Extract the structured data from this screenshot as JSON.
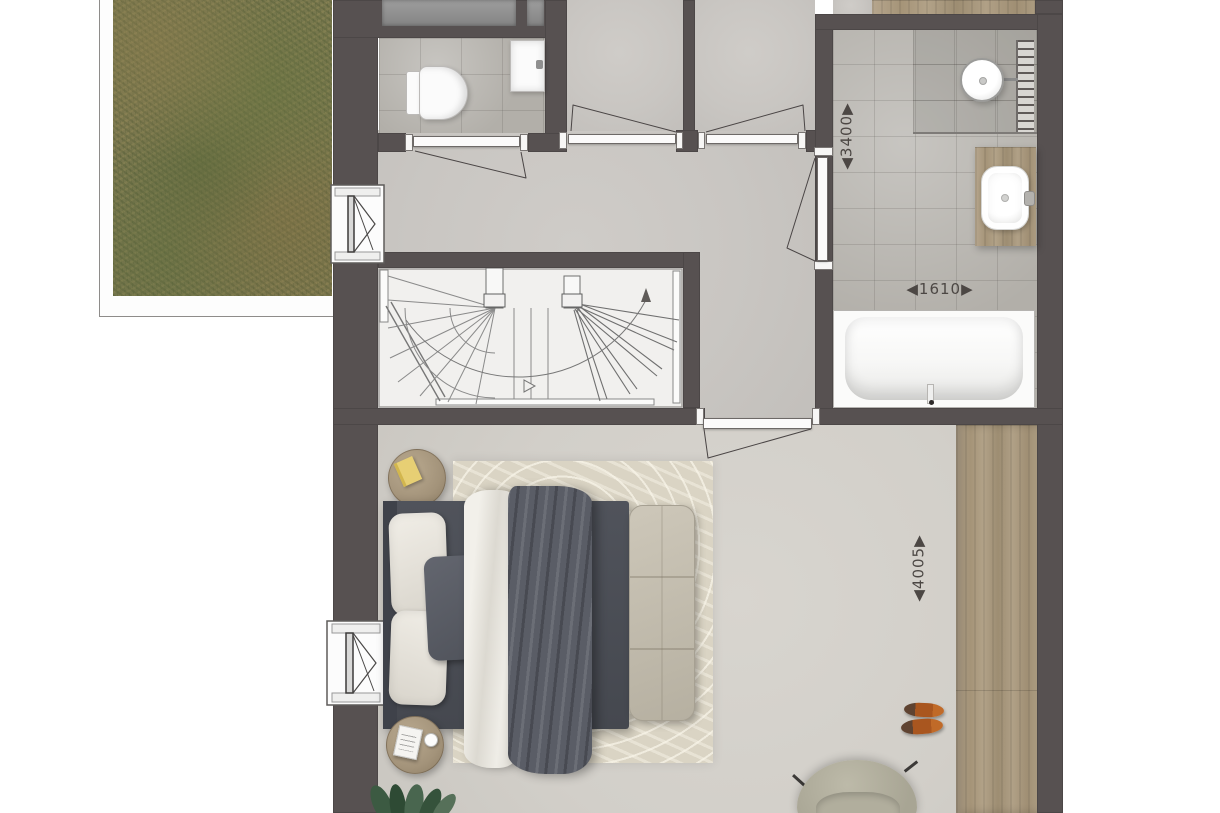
{
  "plan": {
    "type": "floor-plan",
    "dimension_labels": {
      "bathroom_length_mm": "◀3400▶",
      "bathtub_width_mm": "◀1610▶",
      "bedroom_length_mm": "◀4005▶"
    },
    "palette": {
      "wall": "#575151",
      "hall_floor": "#c9c6c2",
      "bedroom_floor": "#d3d0ca",
      "tile_floor": "#b2afa9",
      "shower_tile": "#a19e98",
      "wood": "#ab9b80",
      "green_roof": "#7b7850",
      "bed_frame": "#4c4f57",
      "duvet": "#5a5d66",
      "linen": "#eceae4",
      "bench": "#c4beb0",
      "rug": "#dad4c4",
      "shoes": "#a9561f",
      "armchair": "#b2af9e",
      "dimension_text": "#4c4744"
    }
  }
}
